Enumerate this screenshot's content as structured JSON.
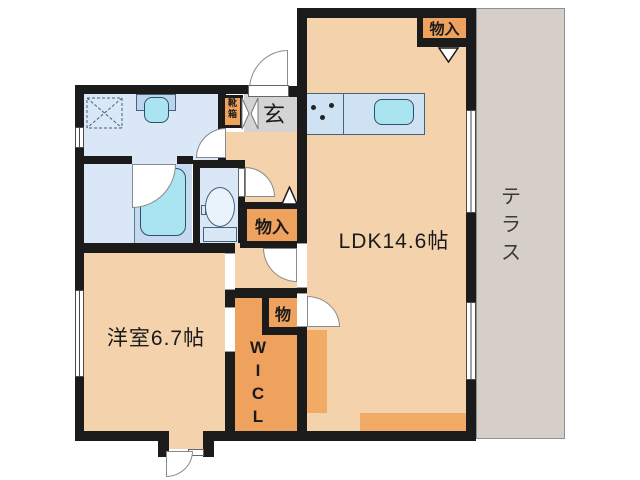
{
  "floorplan": {
    "title": "apartment-floor-plan",
    "rooms": {
      "ldk": {
        "label": "LDK14.6帖"
      },
      "western_room": {
        "label": "洋室6.7帖"
      },
      "entrance": {
        "label": "玄"
      },
      "terrace": {
        "chars": [
          "テ",
          "ラ",
          "ス"
        ]
      },
      "walk_in_closet": {
        "chars": [
          "W",
          "I",
          "C",
          "L"
        ]
      },
      "storage_top": {
        "label": "物入"
      },
      "storage_hall": {
        "label": "物入"
      },
      "storage_small": {
        "label": "物"
      },
      "shoe_cabinet": {
        "chars": [
          "靴",
          "箱"
        ]
      }
    },
    "fixtures": [
      "kitchen-counter",
      "kitchen-sink",
      "stove-burners",
      "washing-machine-area",
      "washbasin",
      "bathtub",
      "toilet"
    ],
    "colors": {
      "wall": "#1b1b1b",
      "room_peach": "#f3d2ac",
      "storage_orange": "#eea25e",
      "water_blue": "#d9e7f6",
      "fixture_cyan": "#a9e4f0",
      "entrance_gray": "#d4d4d4",
      "terrace_gray": "#d6cfc7"
    }
  }
}
